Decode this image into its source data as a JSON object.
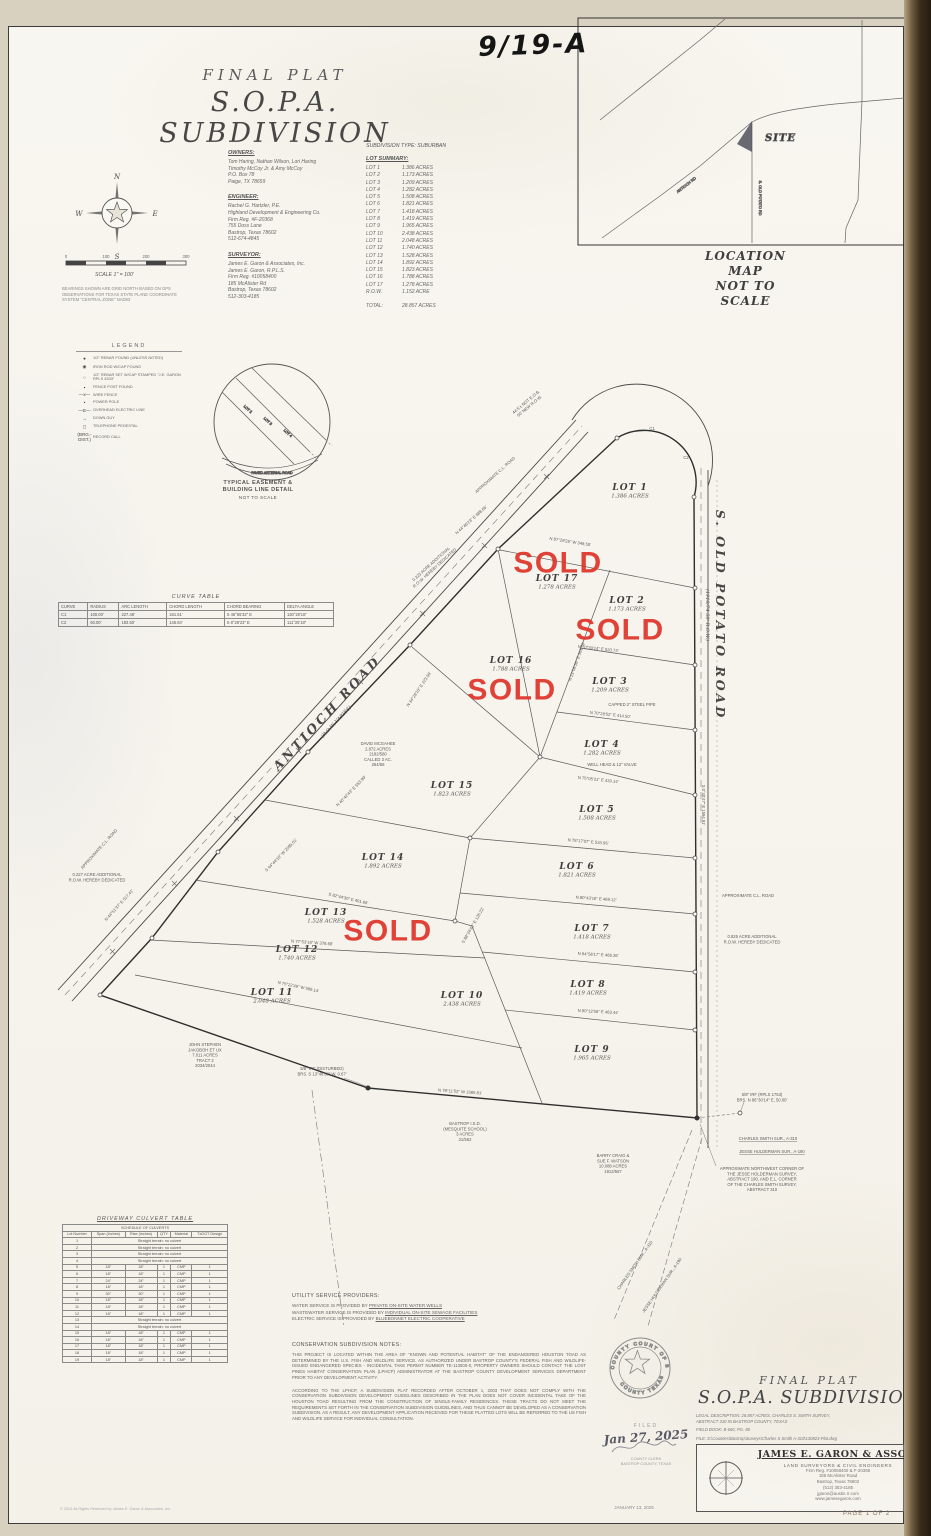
{
  "page": {
    "handwritten_note": "9/19-A",
    "page_number": "PAGE 1 OF 2",
    "plat_date": "JANUARY 13, 2025",
    "copyright": "© 2024 All Rights Reserved by James E. Garon & Associates, Inc."
  },
  "title": {
    "line1": "FINAL PLAT",
    "line2": "S.O.P.A.  SUBDIVISION"
  },
  "location_map": {
    "caption1": "LOCATION MAP",
    "caption2": "NOT TO SCALE",
    "site_label": "SITE",
    "road_labels": [
      {
        "t": "ANTIOCH RD",
        "x": 687,
        "y": 186,
        "r": -38
      },
      {
        "t": "S. OLD POTATO RD",
        "x": 759,
        "y": 198,
        "r": 90
      }
    ]
  },
  "owners": {
    "heading": "OWNERS:",
    "lines": [
      "Tom Haring, Nathan Wilson, Lori Haring",
      "Timothy McCoy Jr. & Amy McCoy",
      "P.O. Box 78",
      "Paige, TX 78659"
    ]
  },
  "engineer": {
    "heading": "ENGINEER:",
    "lines": [
      "Rachel G. Hartzler, P.E.",
      "Highland Development & Engineering Co.",
      "Firm Reg. #F-20368",
      "755 Doss Lane",
      "Bastrop, Texas 78602",
      "512-674-4845"
    ]
  },
  "surveyor": {
    "heading": "SURVEYOR:",
    "lines": [
      "James E. Garon & Associates, Inc.",
      "James E. Garon, R.P.L.S.",
      "Firm Reg. #10058400",
      "185 McAlister Rd",
      "Bastrop, Texas 78602",
      "512-303-4185"
    ]
  },
  "subdivision_type": "SUBDIVISION TYPE: SUBURBAN",
  "lot_summary": {
    "heading": "LOT SUMMARY:",
    "rows": [
      [
        "LOT 1",
        "1.386 ACRES"
      ],
      [
        "LOT 2",
        "1.173 ACRES"
      ],
      [
        "LOT 3",
        "1.209 ACRES"
      ],
      [
        "LOT 4",
        "1.282 ACRES"
      ],
      [
        "LOT 5",
        "1.508 ACRES"
      ],
      [
        "LOT 6",
        "1.821 ACRES"
      ],
      [
        "LOT 7",
        "1.418 ACRES"
      ],
      [
        "LOT 8",
        "1.419 ACRES"
      ],
      [
        "LOT 9",
        "1.965 ACRES"
      ],
      [
        "LOT 10",
        "2.438 ACRES"
      ],
      [
        "LOT 11",
        "2.048 ACRES"
      ],
      [
        "LOT 12",
        "1.740 ACRES"
      ],
      [
        "LOT 13",
        "1.528 ACRES"
      ],
      [
        "LOT 14",
        "1.892 ACRES"
      ],
      [
        "LOT 15",
        "1.823 ACRES"
      ],
      [
        "LOT 16",
        "1.788 ACRES"
      ],
      [
        "LOT 17",
        "1.278 ACRES"
      ],
      [
        "R.O.W.",
        "1.152 ACRE"
      ]
    ],
    "total_label": "TOTAL:",
    "total_value": "28.857 ACRES"
  },
  "compass": {
    "n": "N",
    "s": "S",
    "e": "E",
    "w": "W"
  },
  "scale": {
    "ticks": [
      "0",
      "100",
      "200",
      "300"
    ],
    "caption": "SCALE 1\" = 100'"
  },
  "bearing_note": "BEARINGS SHOWN ARE GRID NORTH BASED ON GPS OBSERVATIONS FOR TEXAS STATE PLANE COORDINATE SYSTEM \"CENTRAL ZONE\" NAD83",
  "legend": {
    "title": "LEGEND",
    "items": [
      {
        "sym": "●",
        "label": "1/2\" REBAR FOUND (UNLESS NOTED)"
      },
      {
        "sym": "◉",
        "label": "IRON ROD W/CAP FOUND"
      },
      {
        "sym": "○",
        "label": "1/2\" REBAR SET W/CAP STAMPED \"J.E. GARON RPLS 4303\""
      },
      {
        "sym": "▪",
        "label": "FENCE POST FOUND"
      },
      {
        "sym": "—x—",
        "label": "WIRE FENCE"
      },
      {
        "sym": "•",
        "label": "POWER POLE"
      },
      {
        "sym": "—E—",
        "label": "OVERHEAD ELECTRIC LINE"
      },
      {
        "sym": "→",
        "label": "DOWN GUY"
      },
      {
        "sym": "◻",
        "label": "TELEPHONE PEDESTAL"
      },
      {
        "sym": "(BRG.-DIST.)",
        "label": "RECORD CALL"
      }
    ]
  },
  "easement_detail": {
    "caption1": "TYPICAL EASEMENT &",
    "caption2": "BUILDING LINE DETAIL",
    "caption3": "NOT TO SCALE",
    "road_label": "PAVED ARTERIAL ROAD",
    "lot_labels": [
      {
        "t": "LOT 2",
        "x": 247,
        "y": 410,
        "r": 42
      },
      {
        "t": "LOT 3",
        "x": 267,
        "y": 422,
        "r": 42
      },
      {
        "t": "LOT 4",
        "x": 287,
        "y": 434,
        "r": 42
      }
    ]
  },
  "curve_table": {
    "title": "CURVE TABLE",
    "headers": [
      "CURVE",
      "RADIUS",
      "ARC LENGTH",
      "CHORD LENGTH",
      "CHORD BEARING",
      "DELTA ANGLE"
    ],
    "rows": [
      [
        "C1",
        "100.00'",
        "227.48'",
        "181.51'",
        "S 46°55'32\" E",
        "130°20'16\""
      ],
      [
        "C2",
        "60.00'",
        "183.50'",
        "145.84'",
        "S 8°28'23\" E",
        "111°25'18\""
      ]
    ]
  },
  "plat": {
    "sold_label": "SOLD",
    "curve_labels": [
      {
        "t": "C1",
        "x": 652,
        "y": 430
      },
      {
        "t": "C2",
        "x": 686,
        "y": 459
      }
    ],
    "roads": [
      {
        "label": "ANTIOCH ROAD",
        "sub": "(R.O.W. VARIES)",
        "x": 330,
        "y": 716,
        "r": -47
      },
      {
        "label": "S. OLD POTATO ROAD",
        "sub": "(1910/74  50' R.O.W.)",
        "x": 716,
        "y": 615,
        "r": 90
      }
    ],
    "lots": [
      {
        "name": "LOT 1",
        "acres": "1.386 ACRES",
        "x": 630,
        "y": 490
      },
      {
        "name": "LOT 2",
        "acres": "1.173 ACRES",
        "x": 627,
        "y": 603,
        "sold": {
          "x": 620,
          "y": 630
        }
      },
      {
        "name": "LOT 3",
        "acres": "1.209 ACRES",
        "x": 610,
        "y": 684
      },
      {
        "name": "LOT 4",
        "acres": "1.282 ACRES",
        "x": 602,
        "y": 747
      },
      {
        "name": "LOT 5",
        "acres": "1.508 ACRES",
        "x": 597,
        "y": 812
      },
      {
        "name": "LOT 6",
        "acres": "1.821 ACRES",
        "x": 577,
        "y": 869
      },
      {
        "name": "LOT 7",
        "acres": "1.418 ACRES",
        "x": 592,
        "y": 931
      },
      {
        "name": "LOT 8",
        "acres": "1.419 ACRES",
        "x": 588,
        "y": 987
      },
      {
        "name": "LOT 9",
        "acres": "1.965 ACRES",
        "x": 592,
        "y": 1052
      },
      {
        "name": "LOT 10",
        "acres": "2.438 ACRES",
        "x": 462,
        "y": 998
      },
      {
        "name": "LOT 11",
        "acres": "2.048 ACRES",
        "x": 272,
        "y": 995
      },
      {
        "name": "LOT 12",
        "acres": "1.740 ACRES",
        "x": 297,
        "y": 952
      },
      {
        "name": "LOT 13",
        "acres": "1.528 ACRES",
        "x": 326,
        "y": 915,
        "sold": {
          "x": 388,
          "y": 931
        }
      },
      {
        "name": "LOT 14",
        "acres": "1.892 ACRES",
        "x": 383,
        "y": 860
      },
      {
        "name": "LOT 15",
        "acres": "1.823 ACRES",
        "x": 452,
        "y": 788
      },
      {
        "name": "LOT 16",
        "acres": "1.788 ACRES",
        "x": 511,
        "y": 663,
        "sold": {
          "x": 512,
          "y": 690
        }
      },
      {
        "name": "LOT 17",
        "acres": "1.278 ACRES",
        "x": 557,
        "y": 581,
        "sold": {
          "x": 558,
          "y": 563
        }
      }
    ],
    "bearings": [
      {
        "t": "N 44°46'23\" E  688.66'",
        "x": 472,
        "y": 521,
        "r": -42
      },
      {
        "t": "S 44°44'16\" W  2095.01'",
        "x": 282,
        "y": 856,
        "r": -46
      },
      {
        "t": "N 44°51'37\" E  517.41'",
        "x": 120,
        "y": 906,
        "r": -48
      },
      {
        "t": "N 40°42'43\" E  553.99'",
        "x": 352,
        "y": 792,
        "r": -46
      },
      {
        "t": "N 34°28'15\" E  223.58'",
        "x": 420,
        "y": 690,
        "r": -56
      },
      {
        "t": "N 87°29'26\" W  348.50'",
        "x": 570,
        "y": 543,
        "r": 9
      },
      {
        "t": "N 23°08'26\" E  303.79'",
        "x": 578,
        "y": 662,
        "r": -70
      },
      {
        "t": "N 70°30'14\" E  520.73'",
        "x": 598,
        "y": 650,
        "r": 6
      },
      {
        "t": "N 70°28'52\" E  414.50'",
        "x": 610,
        "y": 716,
        "r": 6
      },
      {
        "t": "N 75°05'31\" E  433.14'",
        "x": 598,
        "y": 781,
        "r": 6
      },
      {
        "t": "N 78°17'07\" E  533.95'",
        "x": 588,
        "y": 843,
        "r": 5
      },
      {
        "t": "N 80°43'16\" E  469.12'",
        "x": 596,
        "y": 900,
        "r": 4
      },
      {
        "t": "N 84°56'17\" E  466.26'",
        "x": 598,
        "y": 956,
        "r": 3
      },
      {
        "t": "N 80°12'56\" E  463.44'",
        "x": 598,
        "y": 1013,
        "r": 3
      },
      {
        "t": "S 82°44'30\" E  401.66'",
        "x": 348,
        "y": 900,
        "r": 13
      },
      {
        "t": "N 77°53'18\" W  378.66'",
        "x": 312,
        "y": 944,
        "r": 4
      },
      {
        "t": "N 75°22'49\" W  589.14'",
        "x": 298,
        "y": 988,
        "r": 12
      },
      {
        "t": "S 88°24'43\" E  126.22'",
        "x": 474,
        "y": 926,
        "r": -60
      },
      {
        "t": "N 78°11'52\" W  1565.81'",
        "x": 460,
        "y": 1093,
        "r": 4
      },
      {
        "t": "S 0°40'47\" E  1594.91'",
        "x": 702,
        "y": 805,
        "r": 90
      }
    ],
    "annotations": [
      {
        "x": 527,
        "y": 403,
        "r": -40,
        "lines": [
          "44.5'± NOT E.O.B.",
          "50' NEW R.O.W."
        ]
      },
      {
        "x": 496,
        "y": 476,
        "r": -42,
        "lines": [
          "APPROXIMATE C.L. ROAD"
        ]
      },
      {
        "x": 432,
        "y": 565,
        "r": -42,
        "lines": [
          "0.323 ACRE ADDITIONAL",
          "R.O.W. HEREBY DEDICATED"
        ]
      },
      {
        "x": 100,
        "y": 850,
        "r": -48,
        "lines": [
          "APPROXIMATE C.L. ROAD"
        ]
      },
      {
        "x": 97,
        "y": 876,
        "r": 0,
        "lines": [
          "0.227 ACRE ADDITIONAL",
          "R.O.W. HEREBY DEDICATED"
        ]
      },
      {
        "x": 748,
        "y": 897,
        "r": 0,
        "lines": [
          "APPROXIMATE C.L. ROAD"
        ]
      },
      {
        "x": 752,
        "y": 938,
        "r": 0,
        "lines": [
          "0.825 ACRE ADDITIONAL",
          "R.O.W. HEREBY DEDICATED"
        ]
      },
      {
        "x": 378,
        "y": 745,
        "r": 0,
        "lines": [
          "DAVID MCGAHEE",
          "2.872 ACRES",
          "2182/580",
          "CALLED 3 AC.",
          "264/68"
        ]
      },
      {
        "x": 632,
        "y": 706,
        "r": 0,
        "lines": [
          "CAPPED 2\" STEEL PIPE"
        ]
      },
      {
        "x": 612,
        "y": 766,
        "r": 0,
        "lines": [
          "WELL HEAD & 12\" VALVE"
        ]
      },
      {
        "x": 205,
        "y": 1046,
        "r": 0,
        "lines": [
          "JOHN STEPHEN",
          "JAKOBOH ET UX",
          "7.011 ACRES",
          "TRACT 2",
          "2034/2044"
        ]
      },
      {
        "x": 322,
        "y": 1070,
        "r": 0,
        "lines": [
          "5/8\" IRF (DISTURBED)",
          "BRS. S 13°48'58\" W, 0.67'"
        ]
      },
      {
        "x": 465,
        "y": 1125,
        "r": 0,
        "lines": [
          "BASTROP I.S.D.",
          "(MESQUITE SCHOOL)",
          "3 ACRES",
          "21/562"
        ]
      },
      {
        "x": 613,
        "y": 1157,
        "r": 0,
        "lines": [
          "BARRY CRAIG &",
          "SUE F. WATSON",
          "10.088 ACRES",
          "1912/567"
        ]
      },
      {
        "x": 762,
        "y": 1096,
        "r": 0,
        "lines": [
          "5/8\" IRF (RPLS 1753)",
          "BRS. N 86°30'14\" E, 50.00'"
        ]
      },
      {
        "x": 768,
        "y": 1140,
        "r": 0,
        "u": true,
        "lines": [
          "CHARLES SMITH SUR., A-310"
        ]
      },
      {
        "x": 772,
        "y": 1153,
        "r": 0,
        "u": true,
        "lines": [
          "JESSE HULDERMAN SUR., A-190"
        ]
      },
      {
        "x": 762,
        "y": 1170,
        "r": 0,
        "lines": [
          "APPROXIMATE NORTHWEST CORNER OF",
          "THE JESSE HOLDERMAN SURVEY,",
          "ABSTRACT 190, AND E.L. CORNER",
          "OF THE CHARLES SMITH SURVEY,",
          "ABSTRACT 310"
        ]
      },
      {
        "x": 636,
        "y": 1266,
        "r": -55,
        "lines": [
          "CHARLES SMITH SUR., A-310"
        ]
      },
      {
        "x": 663,
        "y": 1286,
        "r": -55,
        "lines": [
          "JESSE HULDERMAN SUR., A-190"
        ]
      }
    ]
  },
  "culvert_table": {
    "title": "DRIVEWAY CULVERT TABLE",
    "subtitle": "SCHEDULE OF CULVERTS",
    "headers": [
      "Lot Number",
      "Span (inches)",
      "Rise (inches)",
      "QTY",
      "Material",
      "TxDOT Design"
    ],
    "rows": [
      {
        "lot": "1",
        "note": "Straight terrain: no culvert"
      },
      {
        "lot": "2",
        "note": "Straight terrain: no culvert"
      },
      {
        "lot": "3",
        "note": "Straight terrain: no culvert"
      },
      {
        "lot": "4",
        "note": "Straight terrain: no culvert"
      },
      {
        "lot": "5",
        "cells": [
          "18\"",
          "18\"",
          "1",
          "CMP",
          "1"
        ]
      },
      {
        "lot": "6",
        "cells": [
          "18\"",
          "18\"",
          "1",
          "CMP",
          "1"
        ]
      },
      {
        "lot": "7",
        "cells": [
          "24\"",
          "24\"",
          "1",
          "CMP",
          "1"
        ]
      },
      {
        "lot": "8",
        "cells": [
          "18\"",
          "18\"",
          "1",
          "CMP",
          "1"
        ]
      },
      {
        "lot": "9",
        "cells": [
          "30\"",
          "30\"",
          "1",
          "CMP",
          "1"
        ]
      },
      {
        "lot": "10",
        "cells": [
          "18\"",
          "18\"",
          "1",
          "CMP",
          "1"
        ]
      },
      {
        "lot": "11",
        "cells": [
          "18\"",
          "18\"",
          "1",
          "CMP",
          "1"
        ]
      },
      {
        "lot": "12",
        "cells": [
          "18\"",
          "18\"",
          "1",
          "CMP",
          "1"
        ]
      },
      {
        "lot": "13",
        "note": "Straight terrain: no culvert"
      },
      {
        "lot": "14",
        "note": "Straight terrain: no culvert"
      },
      {
        "lot": "15",
        "cells": [
          "18\"",
          "18\"",
          "1",
          "CMP",
          "1"
        ]
      },
      {
        "lot": "16",
        "cells": [
          "18\"",
          "18\"",
          "1",
          "CMP",
          "1"
        ]
      },
      {
        "lot": "17",
        "cells": [
          "18\"",
          "18\"",
          "1",
          "CMP",
          "1"
        ]
      },
      {
        "lot": "18",
        "cells": [
          "18\"",
          "18\"",
          "1",
          "CMP",
          "1"
        ]
      },
      {
        "lot": "19",
        "cells": [
          "18\"",
          "18\"",
          "1",
          "CMP",
          "1"
        ]
      }
    ]
  },
  "utilities": {
    "heading": "UTILITY SERVICE PROVIDERS:",
    "lines": [
      {
        "pre": "WATER SERVICE IS PROVIDED BY ",
        "provider": "PRIVATE ON-SITE WATER WELLS"
      },
      {
        "pre": "WASTEWATER SERVICE IS PROVIDED BY ",
        "provider": "INDIVIDUAL ON-SITE SEWAGE FACILITIES"
      },
      {
        "pre": "ELECTRIC SERVICE IS PROVIDED BY ",
        "provider": "BLUEBONNET ELECTRIC COOPERATIVE"
      }
    ]
  },
  "conservation": {
    "heading": "CONSERVATION SUBDIVISION NOTES:",
    "p1": "THIS PROJECT IS LOCATED WITHIN THE AREA OF \"KNOWN AND POTENTIAL HABITAT\" OF THE ENDANGERED HOUSTON TOAD AS DETERMINED BY THE U.S. FISH AND WILDLIFE SERVICE. AS AUTHORIZED UNDER BASTROP COUNTY'S FEDERAL FISH AND WILDLIFE-ISSUED ENDANGERED SPECIES - INCIDENTAL TAKE PERMIT NUMBER TE-113500-0, PROPERTY OWNERS SHOULD CONTACT THE LOST PINES HABITAT CONSERVATION PLAN (LPHCP) ADMINISTRATOR AT THE BASTROP COUNTY DEVELOPMENT SERVICES DEPARTMENT PRIOR TO ANY DEVELOPMENT ACTIVITY.",
    "p2": "ACCORDING TO THE LPHCP, A SUBDIVISION PLAT RECORDED AFTER OCTOBER 1, 2003 THAT DOES NOT COMPLY WITH THE CONSERVATION SUBDIVISION DEVELOPMENT GUIDELINES DESCRIBED IN THE PLAN DOES NOT COVER INCIDENTAL TAKE OF THE HOUSTON TOAD RESULTING FROM THE CONSTRUCTION OF SINGLE-FAMILY RESIDENCES. THESE TRACTS DO NOT MEET THE REQUIREMENTS SET FORTH IN THE CONSERVATION SUBDIVISION GUIDELINES, AND THUS CANNOT BE DEVELOPED AS A CONSERVATION SUBDIVISION. AS A RESULT, ANY DEVELOPMENT APPLICATION RECEIVED FOR THESE PLATTED LOTS WILL BE REFERRED TO THE US FISH AND WILDLIFE SERVICE FOR INDIVIDUAL CONSULTATION."
  },
  "seal": {
    "arc_top": "COUNTY COURT OF BASTROP",
    "arc_bottom": "COUNTY  TEXAS"
  },
  "filed": {
    "label": "FILED",
    "date": "Jan 27, 2025",
    "clerk1": "COUNTY CLERK",
    "clerk2": "BASTROP COUNTY, TEXAS"
  },
  "titleblock": {
    "final_plat": "FINAL PLAT",
    "name": "S.O.P.A.  SUBDIVISION",
    "legal1": "LEGAL DESCRIPTION: 28.857 ACRES, CHARLES S. SMITH SURVEY,",
    "legal2": "ABSTRACT 310 IN BASTROP COUNTY, TEXAS",
    "field_book": "FIELD BOOK: B-660, PG. 80",
    "file": "FILE: S:\\Counties\\Bastrop\\Surveys\\Charles S Smith A-310\\130823-Plat.dwg",
    "firm": "JAMES E. GARON & ASSOC.",
    "firm_sub": "LAND SURVEYORS & CIVIL ENGINEERS",
    "firm_reg": "Firm Reg. #10058400 & F-20368",
    "addr1": "185 McAlister Road",
    "addr2": "Bastrop, Texas 78602",
    "phone": "(512) 303-4185",
    "email": "jgaron@austin.rr.com",
    "web": "www.jamesegaron.com"
  }
}
